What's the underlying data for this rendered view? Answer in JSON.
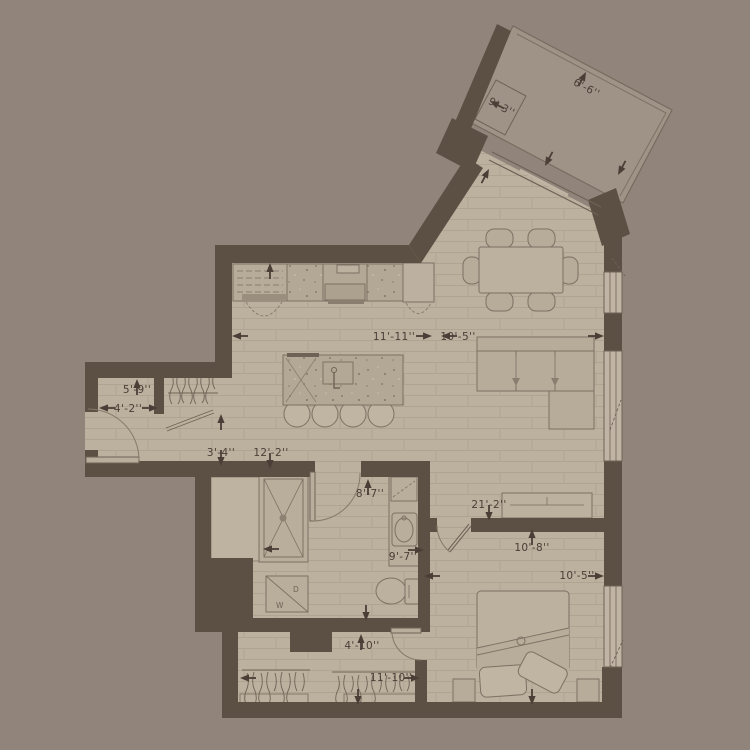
{
  "title": "apartment-floor-plan",
  "colors": {
    "background": "#91847B",
    "wall": "#5C5044",
    "floor": "#BCB09F",
    "floor_line": "#AFA392",
    "balcony_floor": "#9F9387",
    "furniture": "#B7AB9A",
    "furniture_outline": "#7D7164",
    "window": "#C0B4A4",
    "dimension_text": "#4A3F37"
  },
  "dimension_labels": [
    {
      "text": "6'-6''"
    },
    {
      "text": "9'-3''"
    },
    {
      "text": "11'-11''"
    },
    {
      "text": "10'-5''"
    },
    {
      "text": "5'-9''"
    },
    {
      "text": "4'-2''"
    },
    {
      "text": "3'-4''"
    },
    {
      "text": "12'-2''"
    },
    {
      "text": "8'-7''"
    },
    {
      "text": "21'-2''"
    },
    {
      "text": "9'-7''"
    },
    {
      "text": "10'-8''"
    },
    {
      "text": "10'-5''"
    },
    {
      "text": "4'-10''"
    },
    {
      "text": "11'-10''"
    }
  ],
  "laundry": {
    "washer": "W",
    "dryer": "D"
  }
}
